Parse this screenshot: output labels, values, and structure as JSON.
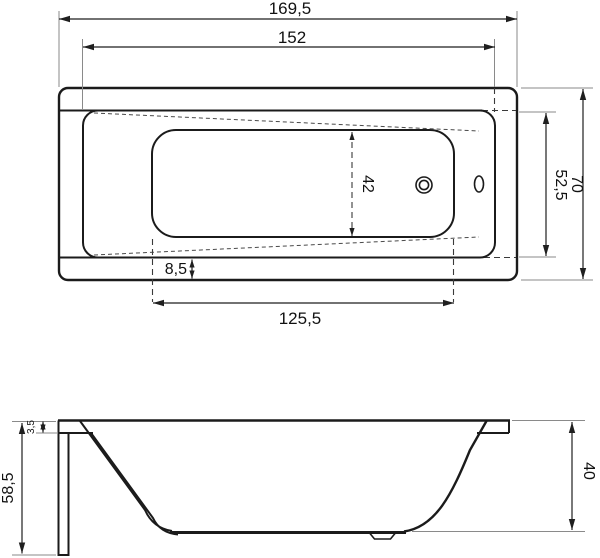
{
  "colors": {
    "background": "#ffffff",
    "line": "#1b1b1b",
    "extension_line": "#8a8a8a",
    "text": "#111111"
  },
  "dims": {
    "top_view": {
      "overall_length": "169,5",
      "inner_length": "152",
      "overall_width": "70",
      "inner_width": "52,5",
      "bottom_width": "42",
      "rim_to_edge": "8,5",
      "bottom_length": "125,5"
    },
    "side_view": {
      "overall_height": "58,5",
      "rim_thickness": "3,5",
      "inner_depth": "40"
    }
  }
}
